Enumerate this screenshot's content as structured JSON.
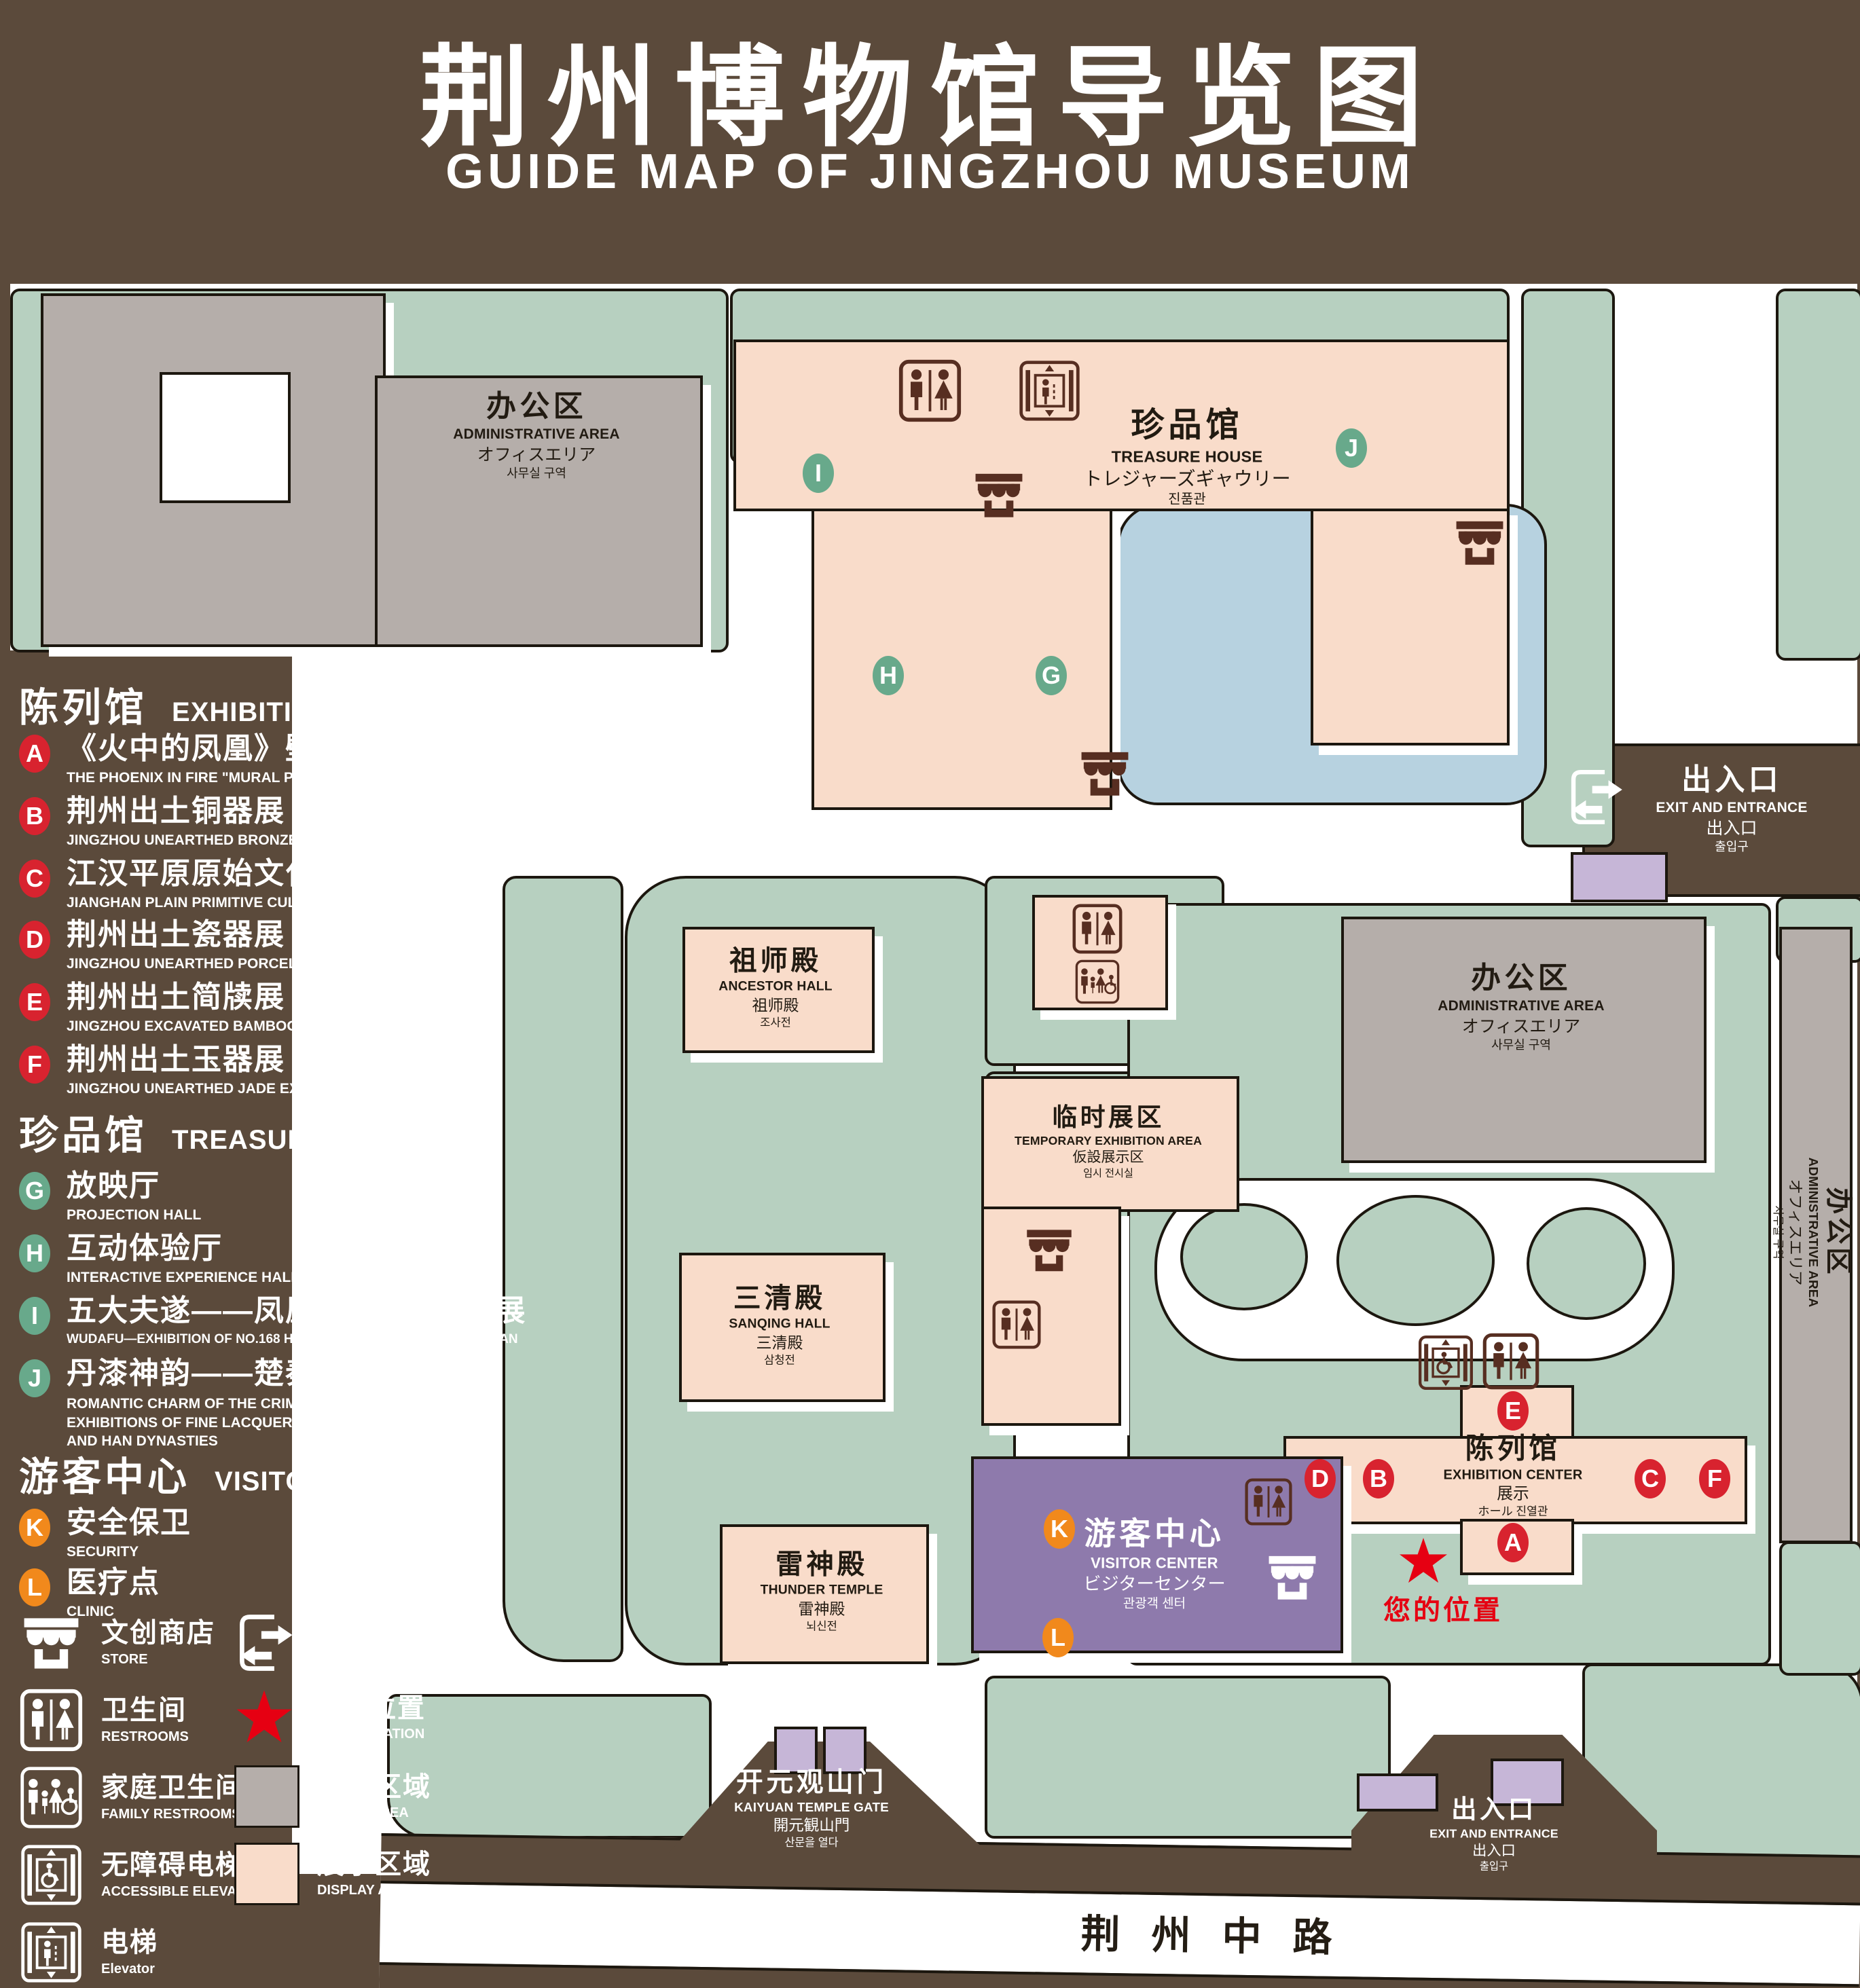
{
  "title": {
    "zh": "荆州博物馆导览图",
    "en": "GUIDE MAP OF JINGZHOU MUSEUM"
  },
  "colors": {
    "background": "#5b4a3b",
    "lawn": "#b7d0c0",
    "display_area": "#f9dcca",
    "office_area": "#b5aeaa",
    "water": "#b7d2e0",
    "visitor_center": "#8e7aac",
    "lavender": "#c6b6d7",
    "marker_red": "#d8232f",
    "marker_green": "#68a98b",
    "marker_orange": "#f1891c",
    "icon_brown": "#572e21",
    "location_red": "#e60012"
  },
  "legend": {
    "sections": [
      {
        "zh": "陈列馆",
        "en": "EXHIBITION CENTER",
        "items": [
          {
            "letter": "A",
            "zh": "《火中的凤凰》壁画",
            "en": "THE PHOENIX IN FIRE \"MURAL PAINTING",
            "floor": "1F"
          },
          {
            "letter": "B",
            "zh": "荆州出土铜器展",
            "en": "JINGZHOU UNEARTHED BRONZE WARE EXHIBITION",
            "floor": "1F"
          },
          {
            "letter": "C",
            "zh": "江汉平原原始文化展",
            "en": "JIANGHAN PLAIN PRIMITIVE CULTURE EXHIBITION",
            "floor": "1F"
          },
          {
            "letter": "D",
            "zh": "荆州出土瓷器展",
            "en": "JINGZHOU UNEARTHED PORCELAIN EXHIBITIONE",
            "floor": "2F"
          },
          {
            "letter": "E",
            "zh": "荆州出土简牍展",
            "en": "JINGZHOU EXCAVATED BAMBOO SLIPS EXHIBITION",
            "floor": "2F"
          },
          {
            "letter": "F",
            "zh": "荆州出土玉器展",
            "en": "JINGZHOU UNEARTHED JADE EXHIBITION",
            "floor": "2F"
          }
        ]
      },
      {
        "zh": "珍品馆",
        "en": "TREASURE HOUSE",
        "items": [
          {
            "letter": "G",
            "zh": "放映厅",
            "en": "PROJECTION HALL",
            "floor": "1F"
          },
          {
            "letter": "H",
            "zh": "互动体验厅",
            "en": "INTERACTIVE EXPERIENCE HALL",
            "floor": "1F"
          },
          {
            "letter": "I",
            "zh": "五大夫遂——凤凰山168号汉墓展",
            "en": "WUDAFU—EXHIBITION OF NO.168 HAN TOMB FROM FENGHUANGSHAN",
            "floor": "2F"
          },
          {
            "letter": "J",
            "zh": "丹漆神韵——楚秦汉漆器精品展",
            "en": "ROMANTIC CHARM OF THE CRIMSON LACQUERS—EXHIBITIONS OF FINE LACQUERS FROM CHU,QIN AND HAN DYNASTIES",
            "floor": "1-2F"
          }
        ]
      },
      {
        "zh": "游客中心",
        "en": "VISITOR CENTER",
        "items": [
          {
            "letter": "K",
            "zh": "安全保卫",
            "en": "SECURITY",
            "floor": "1F"
          },
          {
            "letter": "L",
            "zh": "医疗点",
            "en": "CLINIC",
            "floor": "1F"
          }
        ]
      }
    ],
    "symbols": [
      {
        "zh": "文创商店",
        "en": "STORE",
        "icon": "store-icon"
      },
      {
        "zh": "出入口",
        "en": "EXIT AND ENTRANCE",
        "icon": "exit-icon"
      },
      {
        "zh": "卫生间",
        "en": "RESTROOMS",
        "icon": "restroom-icon"
      },
      {
        "zh": "您的位置",
        "en": "YOUR LOCATION",
        "icon": "location-star-icon"
      },
      {
        "zh": "家庭卫生间",
        "en": "FAMILY RESTROOMS",
        "icon": "family-restroom-icon"
      },
      {
        "zh": "办公区域",
        "en": "OFFICE AREA",
        "icon": "office-swatch"
      },
      {
        "zh": "无障碍电梯",
        "en": "ACCESSIBLE ELEVATOR",
        "icon": "accessible-elevator-icon"
      },
      {
        "zh": "展示区域",
        "en": "DISPLAY AREA",
        "icon": "display-swatch"
      },
      {
        "zh": "电梯",
        "en": "Elevator",
        "icon": "elevator-icon"
      }
    ]
  },
  "map": {
    "buildings": {
      "admin": {
        "zh": "办公区",
        "en": "ADMINISTRATIVE AREA",
        "ja": "オフィスエリア",
        "ko": "사무실 구역"
      },
      "treasure": {
        "zh": "珍品馆",
        "en": "TREASURE HOUSE",
        "ja": "トレジャーズギャウリー",
        "ko": "진품관"
      },
      "ancestor": {
        "zh": "祖师殿",
        "en": "ANCESTOR HALL",
        "ja": "祖师殿",
        "ko": "조사전"
      },
      "temporary": {
        "zh": "临时展区",
        "en": "TEMPORARY EXHIBITION AREA",
        "ja": "仮設展示区",
        "ko": "임시 전시실"
      },
      "sanqing": {
        "zh": "三清殿",
        "en": "SANQING HALL",
        "ja": "三清殿",
        "ko": "삼청전"
      },
      "thunder": {
        "zh": "雷神殿",
        "en": "THUNDER TEMPLE",
        "ja": "雷神殿",
        "ko": "뇌신전"
      },
      "visitor": {
        "zh": "游客中心",
        "en": "VISITOR CENTER",
        "ja": "ビジターセンター",
        "ko": "관광객 센터"
      },
      "exhibition": {
        "zh": "陈列馆",
        "en": "EXHIBITION CENTER",
        "ja": "展示",
        "ko": "ホール 진열관"
      },
      "gate": {
        "zh": "开元观山门",
        "en": "KAIYUAN TEMPLE GATE",
        "ja": "開元観山門",
        "ko": "산문을 열다"
      },
      "exit": {
        "zh": "出入口",
        "en": "EXIT AND ENTRANCE",
        "ja": "出入口",
        "ko": "출입구"
      }
    },
    "road": "荆州中路",
    "your_location": "您的位置",
    "markers": {
      "A": "A",
      "B": "B",
      "C": "C",
      "D": "D",
      "E": "E",
      "F": "F",
      "G": "G",
      "H": "H",
      "I": "I",
      "J": "J",
      "K": "K",
      "L": "L"
    }
  }
}
